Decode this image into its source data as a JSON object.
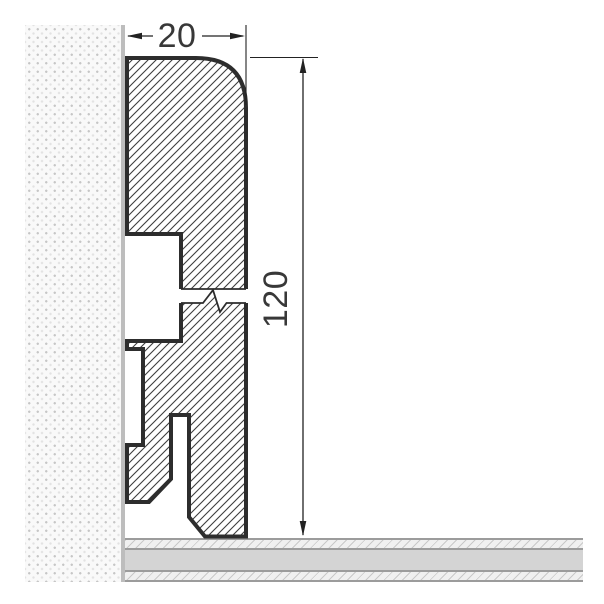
{
  "drawing": {
    "dimensions": {
      "width": {
        "value": "20"
      },
      "height": {
        "value": "120"
      }
    },
    "colors": {
      "profile_outline": "#2d2d2d",
      "hatch_line": "#3e3e3e",
      "dimension_line": "#222222",
      "label_text": "#383838",
      "wall_border": "#bdbdbd",
      "wall_background": "#f9f9f9",
      "floor_solid_layer": "#d4d4d4",
      "floor_edge_line": "#9c9c9c"
    },
    "icons": {
      "break_mark": "zigzag-break-symbol",
      "arrows": "dimension-arrowheads"
    }
  }
}
